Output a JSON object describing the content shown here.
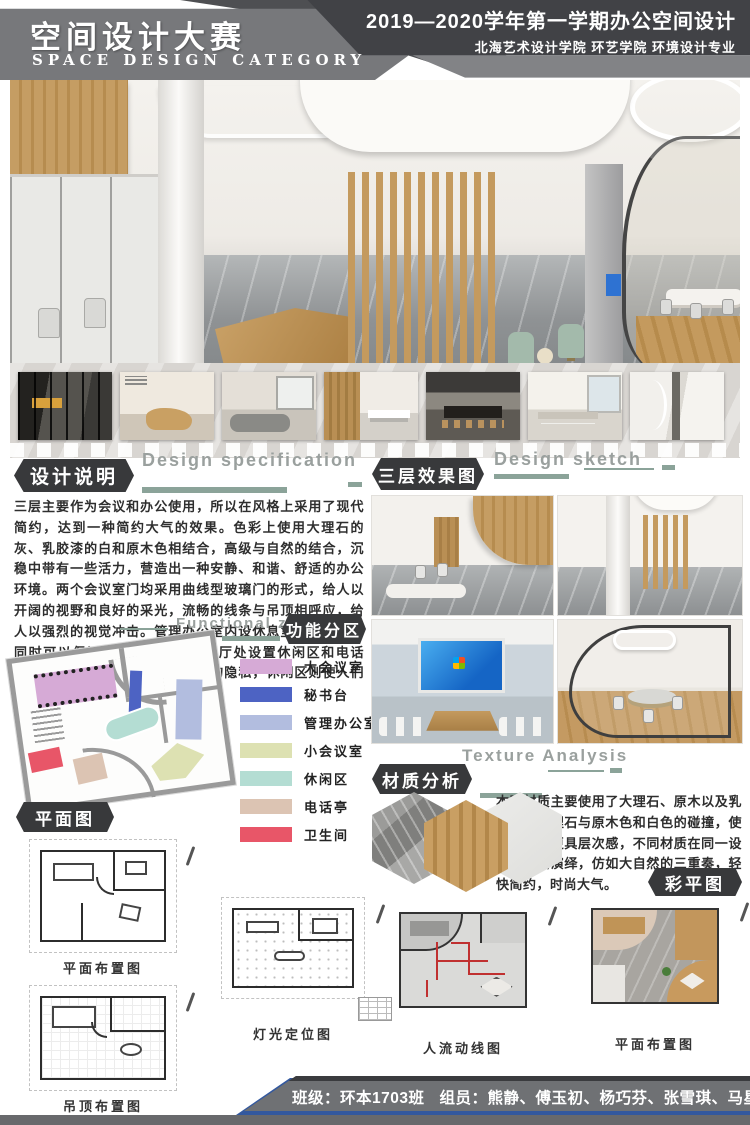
{
  "header": {
    "title_cn": "空间设计大赛",
    "title_en": "SPACE DESIGN CATEGORY",
    "right_line1": "2019—2020学年第一学期办公空间设计",
    "right_line2": "北海艺术设计学院 环艺学院 环境设计专业"
  },
  "design_spec": {
    "badge": "设计说明",
    "title_en": "Design specification",
    "body": "三层主要作为会议和办公使用，所以在风格上采用了现代简约，达到一种简约大气的效果。色彩上使用大理石的灰、乳胶漆的白和原木色相结合，高级与自然的结合，沉稳中带有一些活力，营造出一种安静、和谐、舒适的办公环境。两个会议室门均采用曲线型玻璃门的形式，给人以开阔的视野和良好的采光，流畅的线条与吊顶相呼应，给人以强烈的视觉冲击。管理办公室内设休息室，在办公的同时可以保证有良好的休息。大厅处设置休闲区和电话亭，电话亭可以很好的保障人们的隐私，休闲区则使人们在工作之余可以得到很好的放松。"
  },
  "sketch": {
    "badge": "三层效果图",
    "title_en": "Design sketch"
  },
  "zoning": {
    "badge": "功能分区",
    "title_en": "Functional zoning",
    "legend": [
      {
        "label": "大会议室",
        "color": "#d6aad6"
      },
      {
        "label": "秘书台",
        "color": "#4d63c3"
      },
      {
        "label": "管理办公室",
        "color": "#b2bddf"
      },
      {
        "label": "小会议室",
        "color": "#dde1b2"
      },
      {
        "label": "休闲区",
        "color": "#b4ddd3"
      },
      {
        "label": "电话亭",
        "color": "#dcc4b3"
      },
      {
        "label": "卫生间",
        "color": "#e85668"
      }
    ]
  },
  "plans": {
    "badge": "平面图",
    "floor_plan_caption": "平面布置图",
    "ceiling_plan_caption": "吊顶布置图",
    "lighting_plan_caption": "灯光定位图"
  },
  "texture": {
    "badge": "材质分析",
    "title_en": "Texture Analysis",
    "body": "本案材质主要使用了大理石、原木以及乳胶漆，大理石与原木色和白色的碰撞，使整个空间更具层次感，不同材质在同一设计中融会演绎，仿如大自然的三重奏，轻快简约，时尚大气。"
  },
  "color_plan": {
    "badge": "彩平图",
    "circulation_caption": "人流动线图",
    "layout_caption": "平面布置图"
  },
  "footer": {
    "class_label": "班级：环本1703班",
    "members_label": "组员：熊静、傅玉初、杨巧芬、张雪琪、马星星"
  },
  "palette": {
    "sage_accent": "#8ba399",
    "badge_dark": "#38393b",
    "footer_blue": "#33589e",
    "wood": "#c49a5e",
    "marble_gray": "#8f9294"
  }
}
